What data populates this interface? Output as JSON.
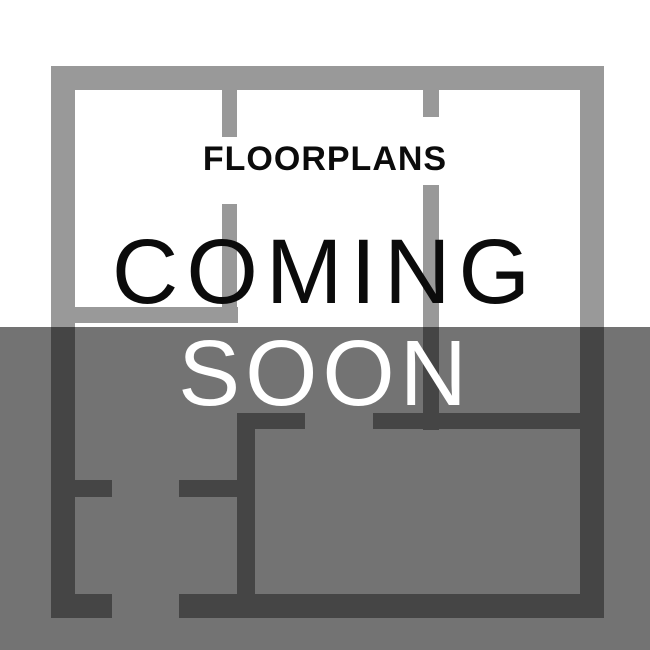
{
  "placeholder": {
    "eyebrow": "FLOORPLANS",
    "title_line1": "COMING",
    "title_line2": "SOON"
  },
  "colors": {
    "page_background": "#ffffff",
    "wall": "#999999",
    "overlay": "rgba(0, 0, 0, 0.55)",
    "dark_text": "#0b0b0b",
    "light_text": "#ffffff"
  },
  "overlay": {
    "top": 327,
    "height": 323
  },
  "floorplan": {
    "description": "background floor-plan line drawing",
    "walls": [
      {
        "name": "outer-top-wall",
        "x": 51,
        "y": 66,
        "w": 553,
        "h": 24
      },
      {
        "name": "outer-left-wall",
        "x": 51,
        "y": 66,
        "w": 24,
        "h": 552
      },
      {
        "name": "outer-right-wall",
        "x": 580,
        "y": 66,
        "w": 24,
        "h": 552
      },
      {
        "name": "outer-bottom-wall-left",
        "x": 51,
        "y": 594,
        "w": 61,
        "h": 24
      },
      {
        "name": "outer-bottom-wall-right",
        "x": 179,
        "y": 594,
        "w": 425,
        "h": 24
      },
      {
        "name": "partition-a-upper",
        "x": 222,
        "y": 90,
        "w": 15,
        "h": 47
      },
      {
        "name": "partition-a-lower",
        "x": 222,
        "y": 204,
        "w": 15,
        "h": 119
      },
      {
        "name": "upper-left-room-bottom-wall",
        "x": 75,
        "y": 307,
        "w": 163,
        "h": 16
      },
      {
        "name": "partition-b-upper",
        "x": 423,
        "y": 90,
        "w": 16,
        "h": 27
      },
      {
        "name": "partition-b-lower",
        "x": 423,
        "y": 185,
        "w": 16,
        "h": 245
      },
      {
        "name": "lower-room-left-wall",
        "x": 237,
        "y": 413,
        "w": 18,
        "h": 205
      },
      {
        "name": "lower-room-top-wall-left",
        "x": 237,
        "y": 413,
        "w": 68,
        "h": 16
      },
      {
        "name": "lower-room-top-wall-right",
        "x": 373,
        "y": 413,
        "w": 207,
        "h": 16
      },
      {
        "name": "left-stub-wall",
        "x": 75,
        "y": 480,
        "w": 37,
        "h": 17
      },
      {
        "name": "right-stub-wall",
        "x": 179,
        "y": 480,
        "w": 58,
        "h": 17
      }
    ]
  }
}
